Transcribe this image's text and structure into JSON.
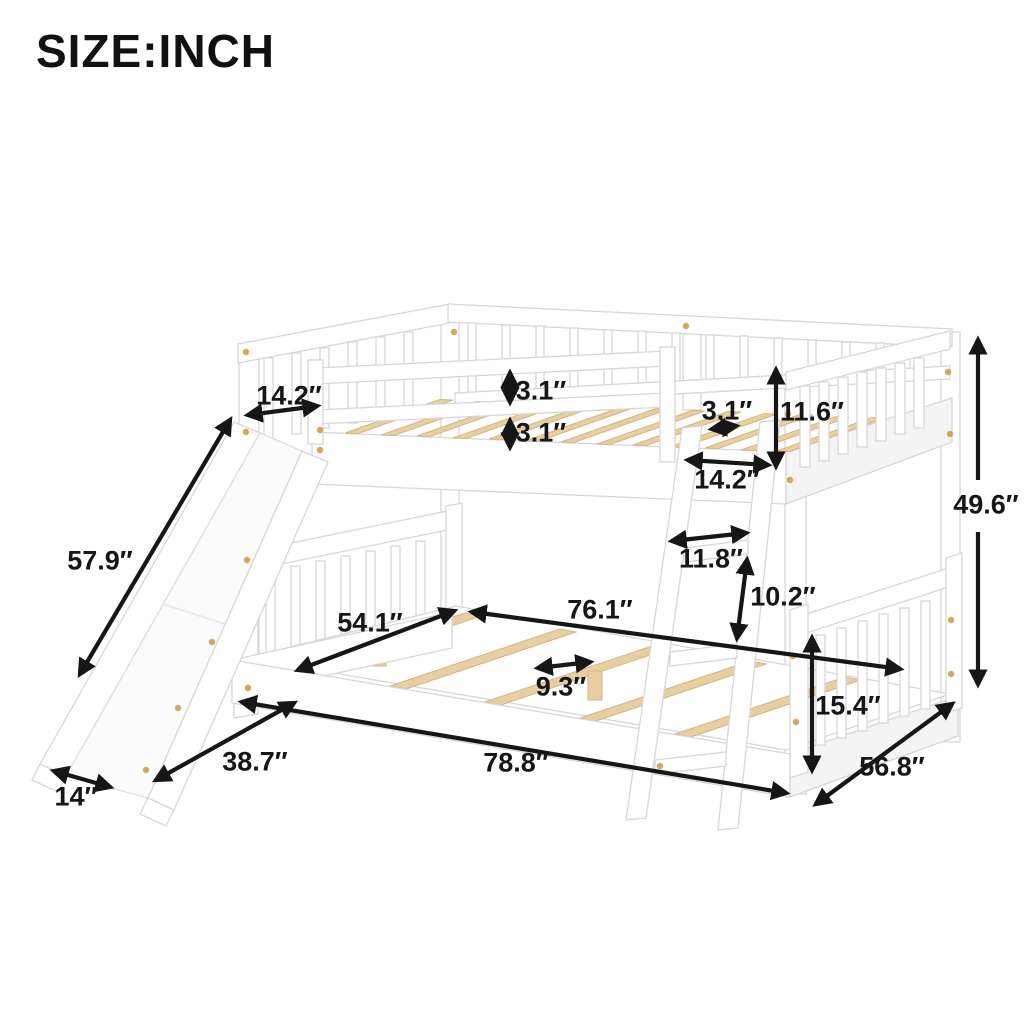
{
  "title": "SIZE:INCH",
  "unit": "inch",
  "diagram": {
    "product": "full-over-full bunk bed with slide and ladder",
    "colors": {
      "frame": "#ffffff",
      "frame_outline": "#d7d7d7",
      "slats_wood": "#e8cfa2",
      "annotation": "#161616",
      "screw_dots": "#c9a24a",
      "background": "#ffffff"
    },
    "dimensions": [
      {
        "id": "slide-top-opening-width",
        "value": "14.2″"
      },
      {
        "id": "guardrail-gap-top",
        "value": "3.1″"
      },
      {
        "id": "guardrail-gap-bottom",
        "value": "3.1″"
      },
      {
        "id": "upper-slat-spacing",
        "value": "3.1″"
      },
      {
        "id": "upper-guardrail-height",
        "value": "11.6″"
      },
      {
        "id": "ladder-opening-width",
        "value": "14.2″"
      },
      {
        "id": "overall-height",
        "value": "49.6″"
      },
      {
        "id": "slide-length",
        "value": "57.9″"
      },
      {
        "id": "ladder-width",
        "value": "11.8″"
      },
      {
        "id": "ladder-rung-spacing",
        "value": "10.2″"
      },
      {
        "id": "lower-bed-inner-width",
        "value": "54.1″"
      },
      {
        "id": "lower-bed-inner-length",
        "value": "76.1″"
      },
      {
        "id": "lower-slat-spacing",
        "value": "9.3″"
      },
      {
        "id": "lower-bed-height",
        "value": "15.4″"
      },
      {
        "id": "overall-length",
        "value": "78.8″"
      },
      {
        "id": "slide-footprint-depth",
        "value": "38.7″"
      },
      {
        "id": "slide-width",
        "value": "14″"
      },
      {
        "id": "overall-depth",
        "value": "56.8″"
      }
    ]
  }
}
